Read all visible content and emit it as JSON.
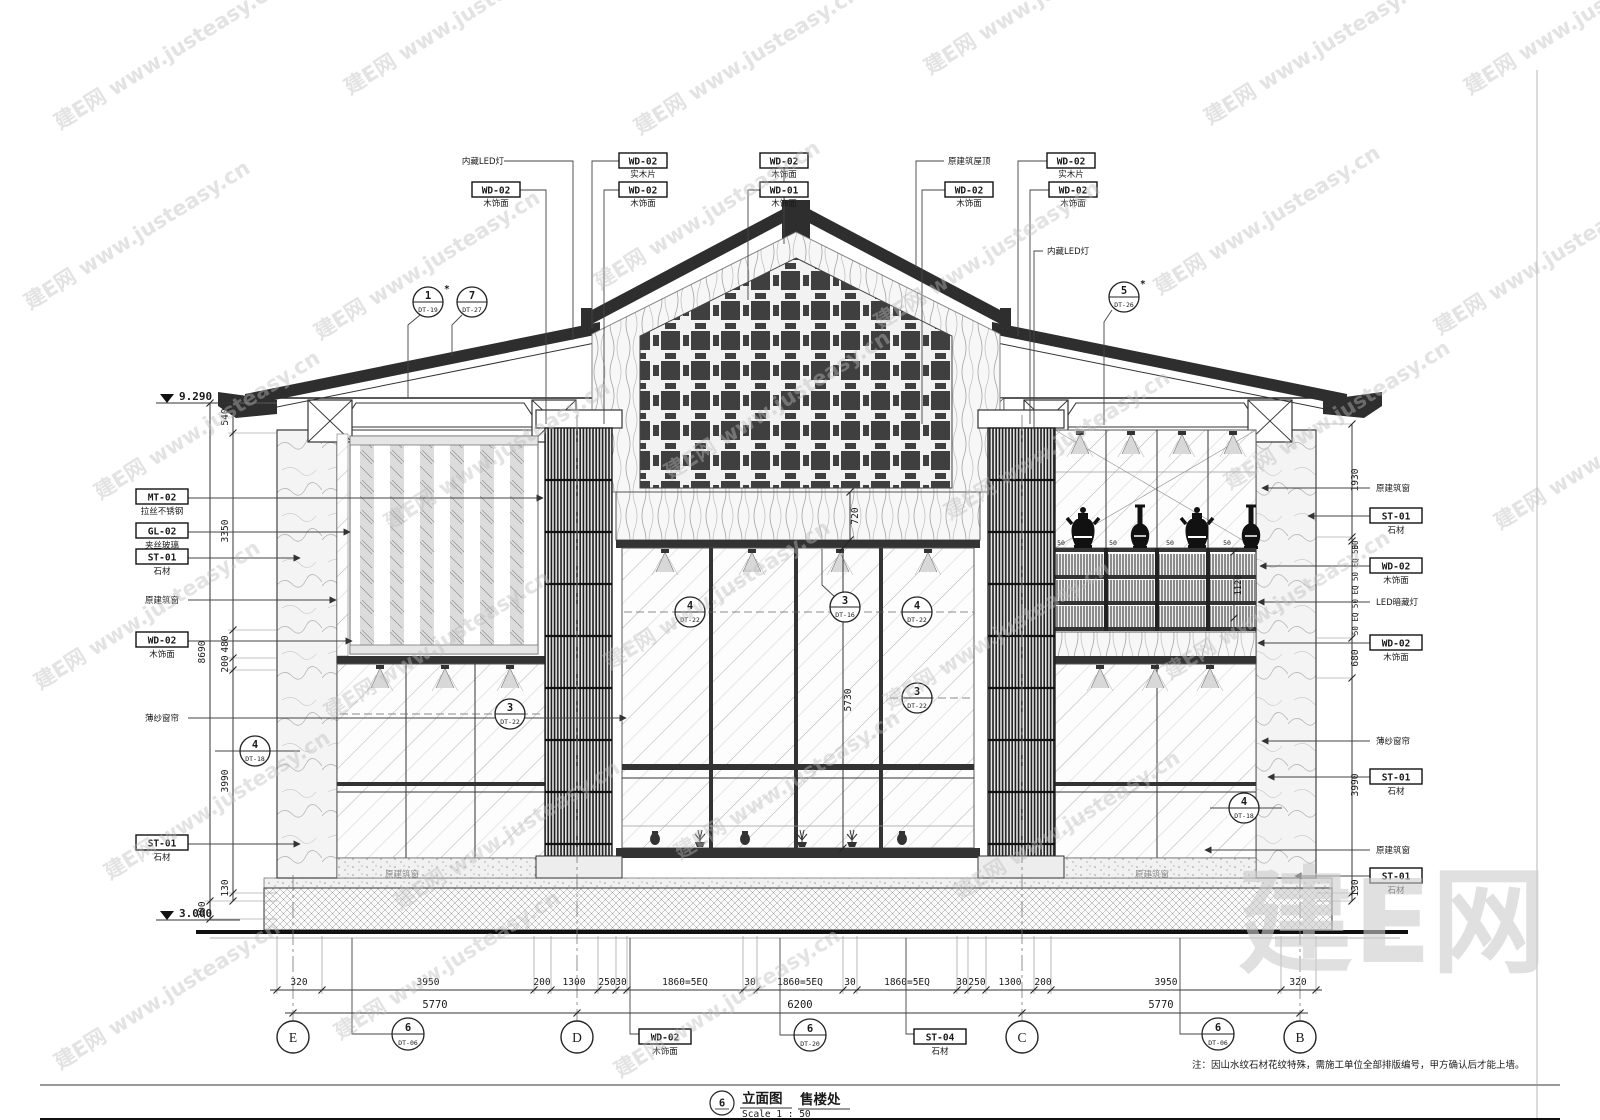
{
  "watermark": {
    "text": "建E网 www.justeasy.cn",
    "big": "建E网"
  },
  "title_block": {
    "number": "6",
    "type_label": "立面图",
    "name": "售楼处",
    "scale": "Scale 1 : 50"
  },
  "note": "注：因山水纹石材花纹特殊，需施工单位全部排版编号，甲方确认后才能上墙。",
  "elevation": {
    "top": "9.290",
    "bottom": "3.000"
  },
  "grid_bubbles": [
    "E",
    "D",
    "C",
    "B"
  ],
  "callouts": {
    "top": [
      {
        "code": "WD-02",
        "sub": "木饰面"
      },
      {
        "code": "WD-02",
        "sub": "实木片"
      },
      {
        "code": "WD-02",
        "sub": "木饰面"
      },
      {
        "code": "WD-02",
        "sub": "木饰面"
      },
      {
        "code": "WD-01",
        "sub": "木饰面"
      },
      {
        "code": "WD-02",
        "sub": "木饰面"
      },
      {
        "code": "WD-02",
        "sub": "实木片"
      },
      {
        "code": "WD-02",
        "sub": "木饰面"
      }
    ],
    "top_texts": [
      "内藏LED灯",
      "原建筑屋顶",
      "内藏LED灯"
    ],
    "left": [
      {
        "code": "MT-02",
        "sub": "拉丝不锈钢"
      },
      {
        "code": "GL-02",
        "sub": "夹丝玻璃"
      },
      {
        "code": "ST-01",
        "sub": "石材"
      },
      {
        "code": "WD-02",
        "sub": "木饰面"
      },
      {
        "code": "ST-01",
        "sub": "石材"
      }
    ],
    "left_texts": [
      "原建筑窗",
      "薄纱窗帘"
    ],
    "right": [
      {
        "code": "ST-01",
        "sub": "石材"
      },
      {
        "code": "WD-02",
        "sub": "木饰面"
      },
      {
        "code": "WD-02",
        "sub": "木饰面"
      },
      {
        "code": "ST-01",
        "sub": "石材"
      },
      {
        "code": "ST-01",
        "sub": "石材"
      }
    ],
    "right_texts": [
      "原建筑窗",
      "LED暗藏灯",
      "薄纱窗帘",
      "原建筑窗"
    ],
    "bottom": [
      {
        "code": "WD-02",
        "sub": "木饰面"
      },
      {
        "code": "ST-04",
        "sub": "石材"
      }
    ],
    "inner": [
      "原建筑窗",
      "原建筑窗"
    ]
  },
  "markers": [
    {
      "num": "1",
      "code": "DT-19",
      "star": "*"
    },
    {
      "num": "7",
      "code": "DT-27",
      "star": ""
    },
    {
      "num": "5",
      "code": "DT-26",
      "star": "*"
    },
    {
      "num": "4",
      "code": "DT-22",
      "star": ""
    },
    {
      "num": "3",
      "code": "DT-16",
      "star": ""
    },
    {
      "num": "4",
      "code": "DT-22",
      "star": ""
    },
    {
      "num": "3",
      "code": "DT-22",
      "star": ""
    },
    {
      "num": "3",
      "code": "DT-22",
      "star": ""
    },
    {
      "num": "4",
      "code": "DT-18",
      "star": ""
    },
    {
      "num": "4",
      "code": "DT-18",
      "star": ""
    },
    {
      "num": "6",
      "code": "DT-06",
      "star": ""
    },
    {
      "num": "6",
      "code": "DT-20",
      "star": ""
    },
    {
      "num": "6",
      "code": "DT-06",
      "star": ""
    }
  ],
  "dims": {
    "left": [
      "540",
      "3350",
      "480",
      "200",
      "3990",
      "130"
    ],
    "left_outer": [
      "8690",
      "300"
    ],
    "right": [
      "1930",
      "50",
      "50 EQ 50 EQ 50 EQ 50",
      "680",
      "3990",
      "130"
    ],
    "center": [
      "720",
      "5730",
      "1120"
    ],
    "shelf_eq": [
      "50",
      "50",
      "50",
      "50"
    ],
    "bottom_row1": [
      "320",
      "3950",
      "200",
      "1300",
      "250",
      "30",
      "1860=5EQ",
      "30",
      "1860=5EQ",
      "30",
      "1860=5EQ",
      "30",
      "250",
      "1300",
      "200",
      "3950",
      "320"
    ],
    "bottom_row2": [
      "5770",
      "6200",
      "5770"
    ]
  }
}
